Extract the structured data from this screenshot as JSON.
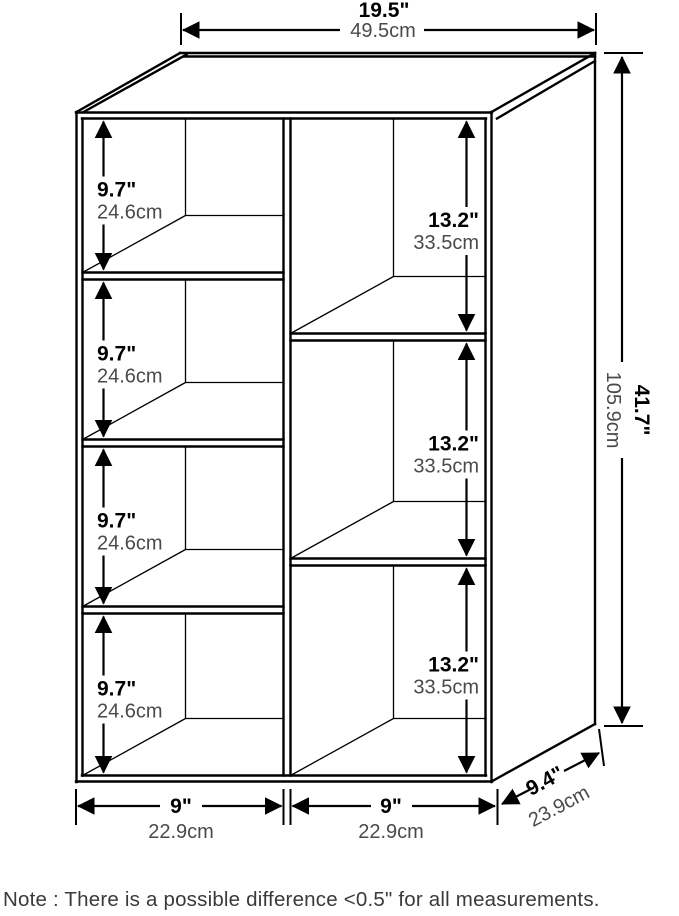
{
  "diagram": {
    "description": "bookshelf-dimension-drawing",
    "line_color": "#000000",
    "light_text_color": "#4a4a4a",
    "top_width": {
      "inches": "19.5\"",
      "cm": "49.5cm"
    },
    "height": {
      "inches": "41.7\"",
      "cm": "105.9cm"
    },
    "depth": {
      "inches": "9.4\"",
      "cm": "23.9cm"
    },
    "left_cells": [
      {
        "inches": "9.7\"",
        "cm": "24.6cm"
      },
      {
        "inches": "9.7\"",
        "cm": "24.6cm"
      },
      {
        "inches": "9.7\"",
        "cm": "24.6cm"
      },
      {
        "inches": "9.7\"",
        "cm": "24.6cm"
      }
    ],
    "right_cells": [
      {
        "inches": "13.2\"",
        "cm": "33.5cm"
      },
      {
        "inches": "13.2\"",
        "cm": "33.5cm"
      },
      {
        "inches": "13.2\"",
        "cm": "33.5cm"
      }
    ],
    "bottom_widths": [
      {
        "inches": "9\"",
        "cm": "22.9cm"
      },
      {
        "inches": "9\"",
        "cm": "22.9cm"
      }
    ]
  },
  "note": "Note : There is a possible difference <0.5\" for all measurements."
}
